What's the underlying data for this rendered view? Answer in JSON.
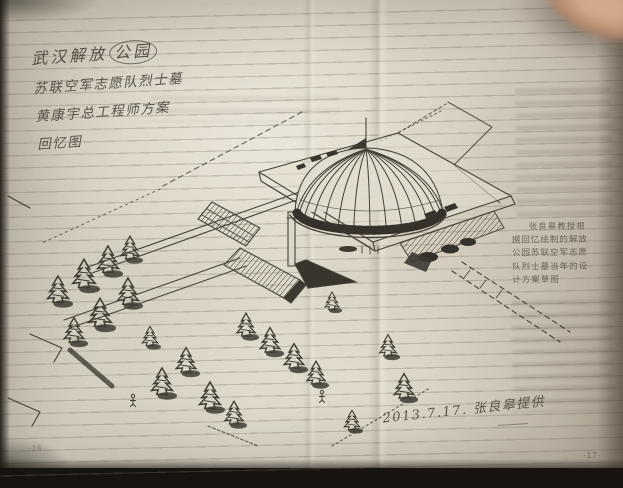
{
  "colors": {
    "background": "#171310",
    "page": "#d8d2c5",
    "ink": "#3e3930",
    "handwriting": "#57514a",
    "caption_text": "#6b6459",
    "finger": "#c9a084"
  },
  "left_page": {
    "handwritten_title": {
      "line1_prefix": "武汉解放",
      "line1_circled": "公园",
      "line2": "苏联空军志愿队烈士墓",
      "line3": "黄康宇总工程师方案",
      "line4": "回忆图"
    },
    "page_number": "·16·"
  },
  "right_page": {
    "caption_lines": [
      "张良皋教授根",
      "据回忆绘制的解放",
      "公园苏联空军志愿",
      "队烈士墓当年的设",
      "计方案草图"
    ],
    "handwritten_date": "2013.7.17. 张良皋提供",
    "page_number": "·17·"
  }
}
